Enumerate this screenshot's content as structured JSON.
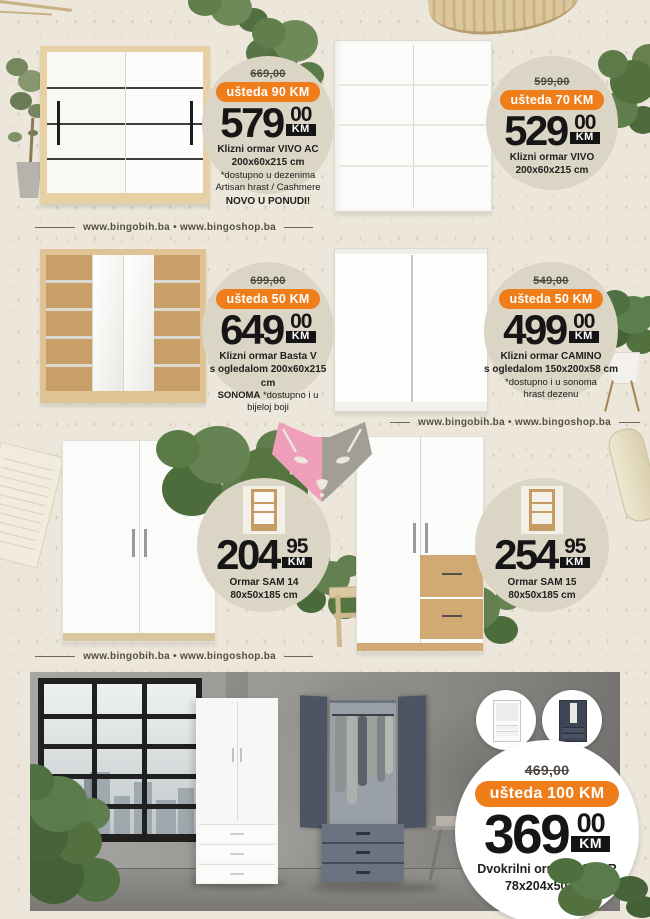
{
  "page": {
    "website_links": "www.bingobih.ba • www.bingoshop.ba",
    "colors": {
      "background": "#ece7da",
      "bubble_beige": "#dbd5c6",
      "badge_orange": "#ef7d1a",
      "price_black": "#141414",
      "fox_pink": "#ef9fba",
      "fox_gray": "#a29e96"
    }
  },
  "products": [
    {
      "old_price": "669,00",
      "badge": "ušteda 90 KM",
      "price": "579",
      "cents": "00",
      "currency": "KM",
      "line1": "Klizni ormar VIVO AC",
      "line2": "200x60x215 cm",
      "line3": "*dostupno u dezenima",
      "line4": "Artisan hrast / Cashmere",
      "line5": "NOVO U PONUDI!"
    },
    {
      "old_price": "599,00",
      "badge": "ušteda 70 KM",
      "price": "529",
      "cents": "00",
      "currency": "KM",
      "line1": "Klizni ormar VIVO",
      "line2": "200x60x215 cm"
    },
    {
      "old_price": "699,00",
      "badge": "ušteda 50 KM",
      "price": "649",
      "cents": "00",
      "currency": "KM",
      "line1": "Klizni ormar Basta V",
      "line2": "s ogledalom 200x60x215 cm",
      "line3_bold": "SONOMA",
      "line3": "*dostupno i u",
      "line4": "bijeloj boji"
    },
    {
      "old_price": "549,00",
      "badge": "ušteda 50 KM",
      "price": "499",
      "cents": "00",
      "currency": "KM",
      "line1": "Klizni ormar CAMINO",
      "line2": "s ogledalom 150x200x58 cm",
      "line3": "*dostupno i u sonoma",
      "line4": "hrast dezenu"
    },
    {
      "price": "204",
      "cents": "95",
      "currency": "KM",
      "line1": "Ormar SAM 14",
      "line2": "80x50x185 cm"
    },
    {
      "price": "254",
      "cents": "95",
      "currency": "KM",
      "line1": "Ormar SAM 15",
      "line2": "80x50x185 cm"
    },
    {
      "old_price": "469,00",
      "badge": "ušteda 100 KM",
      "price": "369",
      "cents": "00",
      "currency": "KM",
      "line1": "Dvokrilni ormar GELAR",
      "line2": "78x204x50 cm"
    }
  ]
}
